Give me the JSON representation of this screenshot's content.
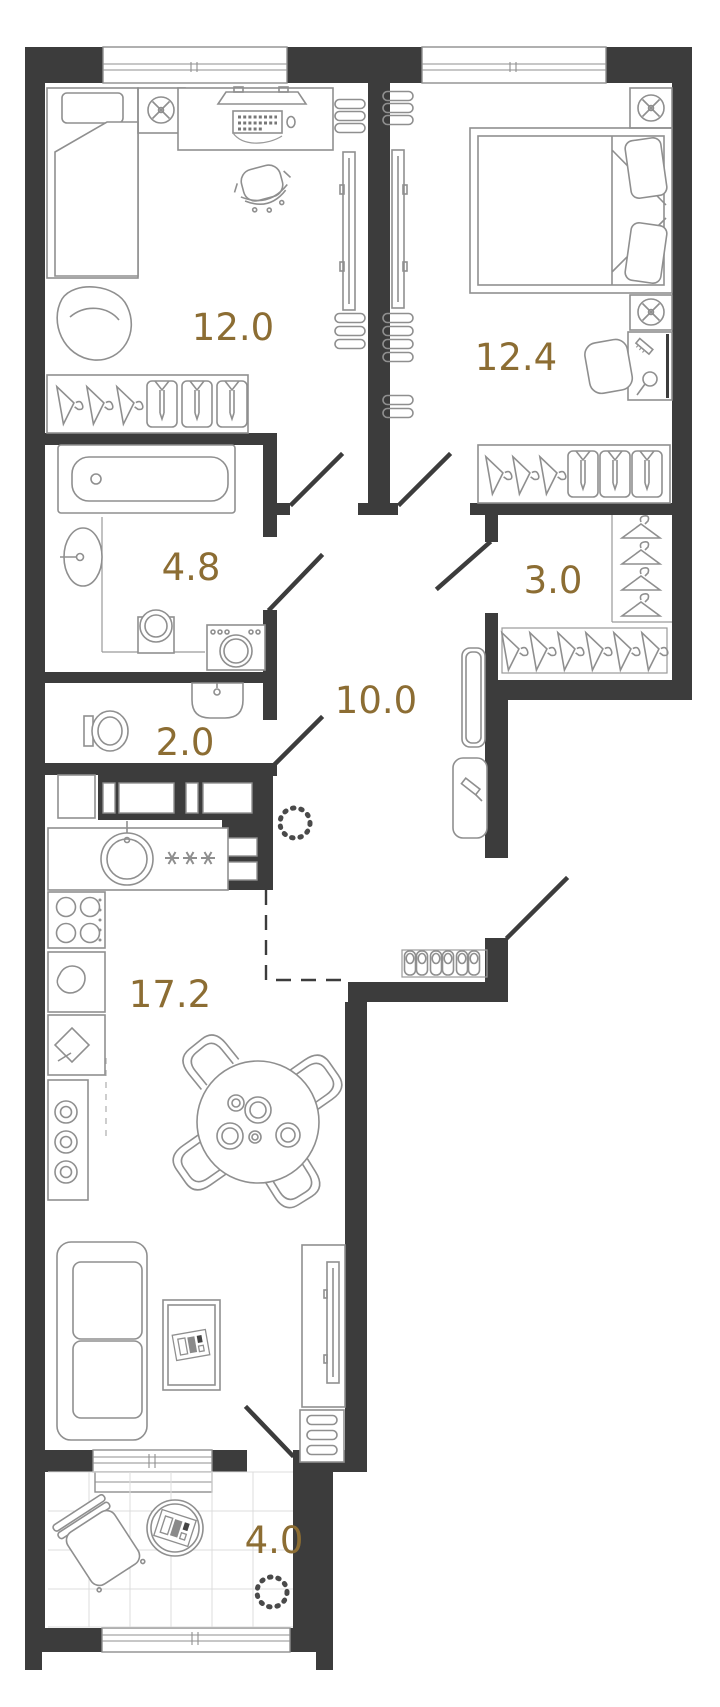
{
  "floor_plan": {
    "background_color": "#ffffff",
    "wall_color": "#3c3c3c",
    "furniture_line_color": "#8f8f8f",
    "area_label_color": "#8c6d33",
    "rooms": [
      {
        "name": "bedroom-1",
        "area_label": "12.0"
      },
      {
        "name": "bedroom-2",
        "area_label": "12.4"
      },
      {
        "name": "bathroom",
        "area_label": "4.8"
      },
      {
        "name": "dressing-room",
        "area_label": "3.0"
      },
      {
        "name": "wc",
        "area_label": "2.0"
      },
      {
        "name": "hallway",
        "area_label": "10.0"
      },
      {
        "name": "kitchen-living-room",
        "area_label": "17.2"
      },
      {
        "name": "balcony",
        "area_label": "4.0"
      }
    ]
  }
}
